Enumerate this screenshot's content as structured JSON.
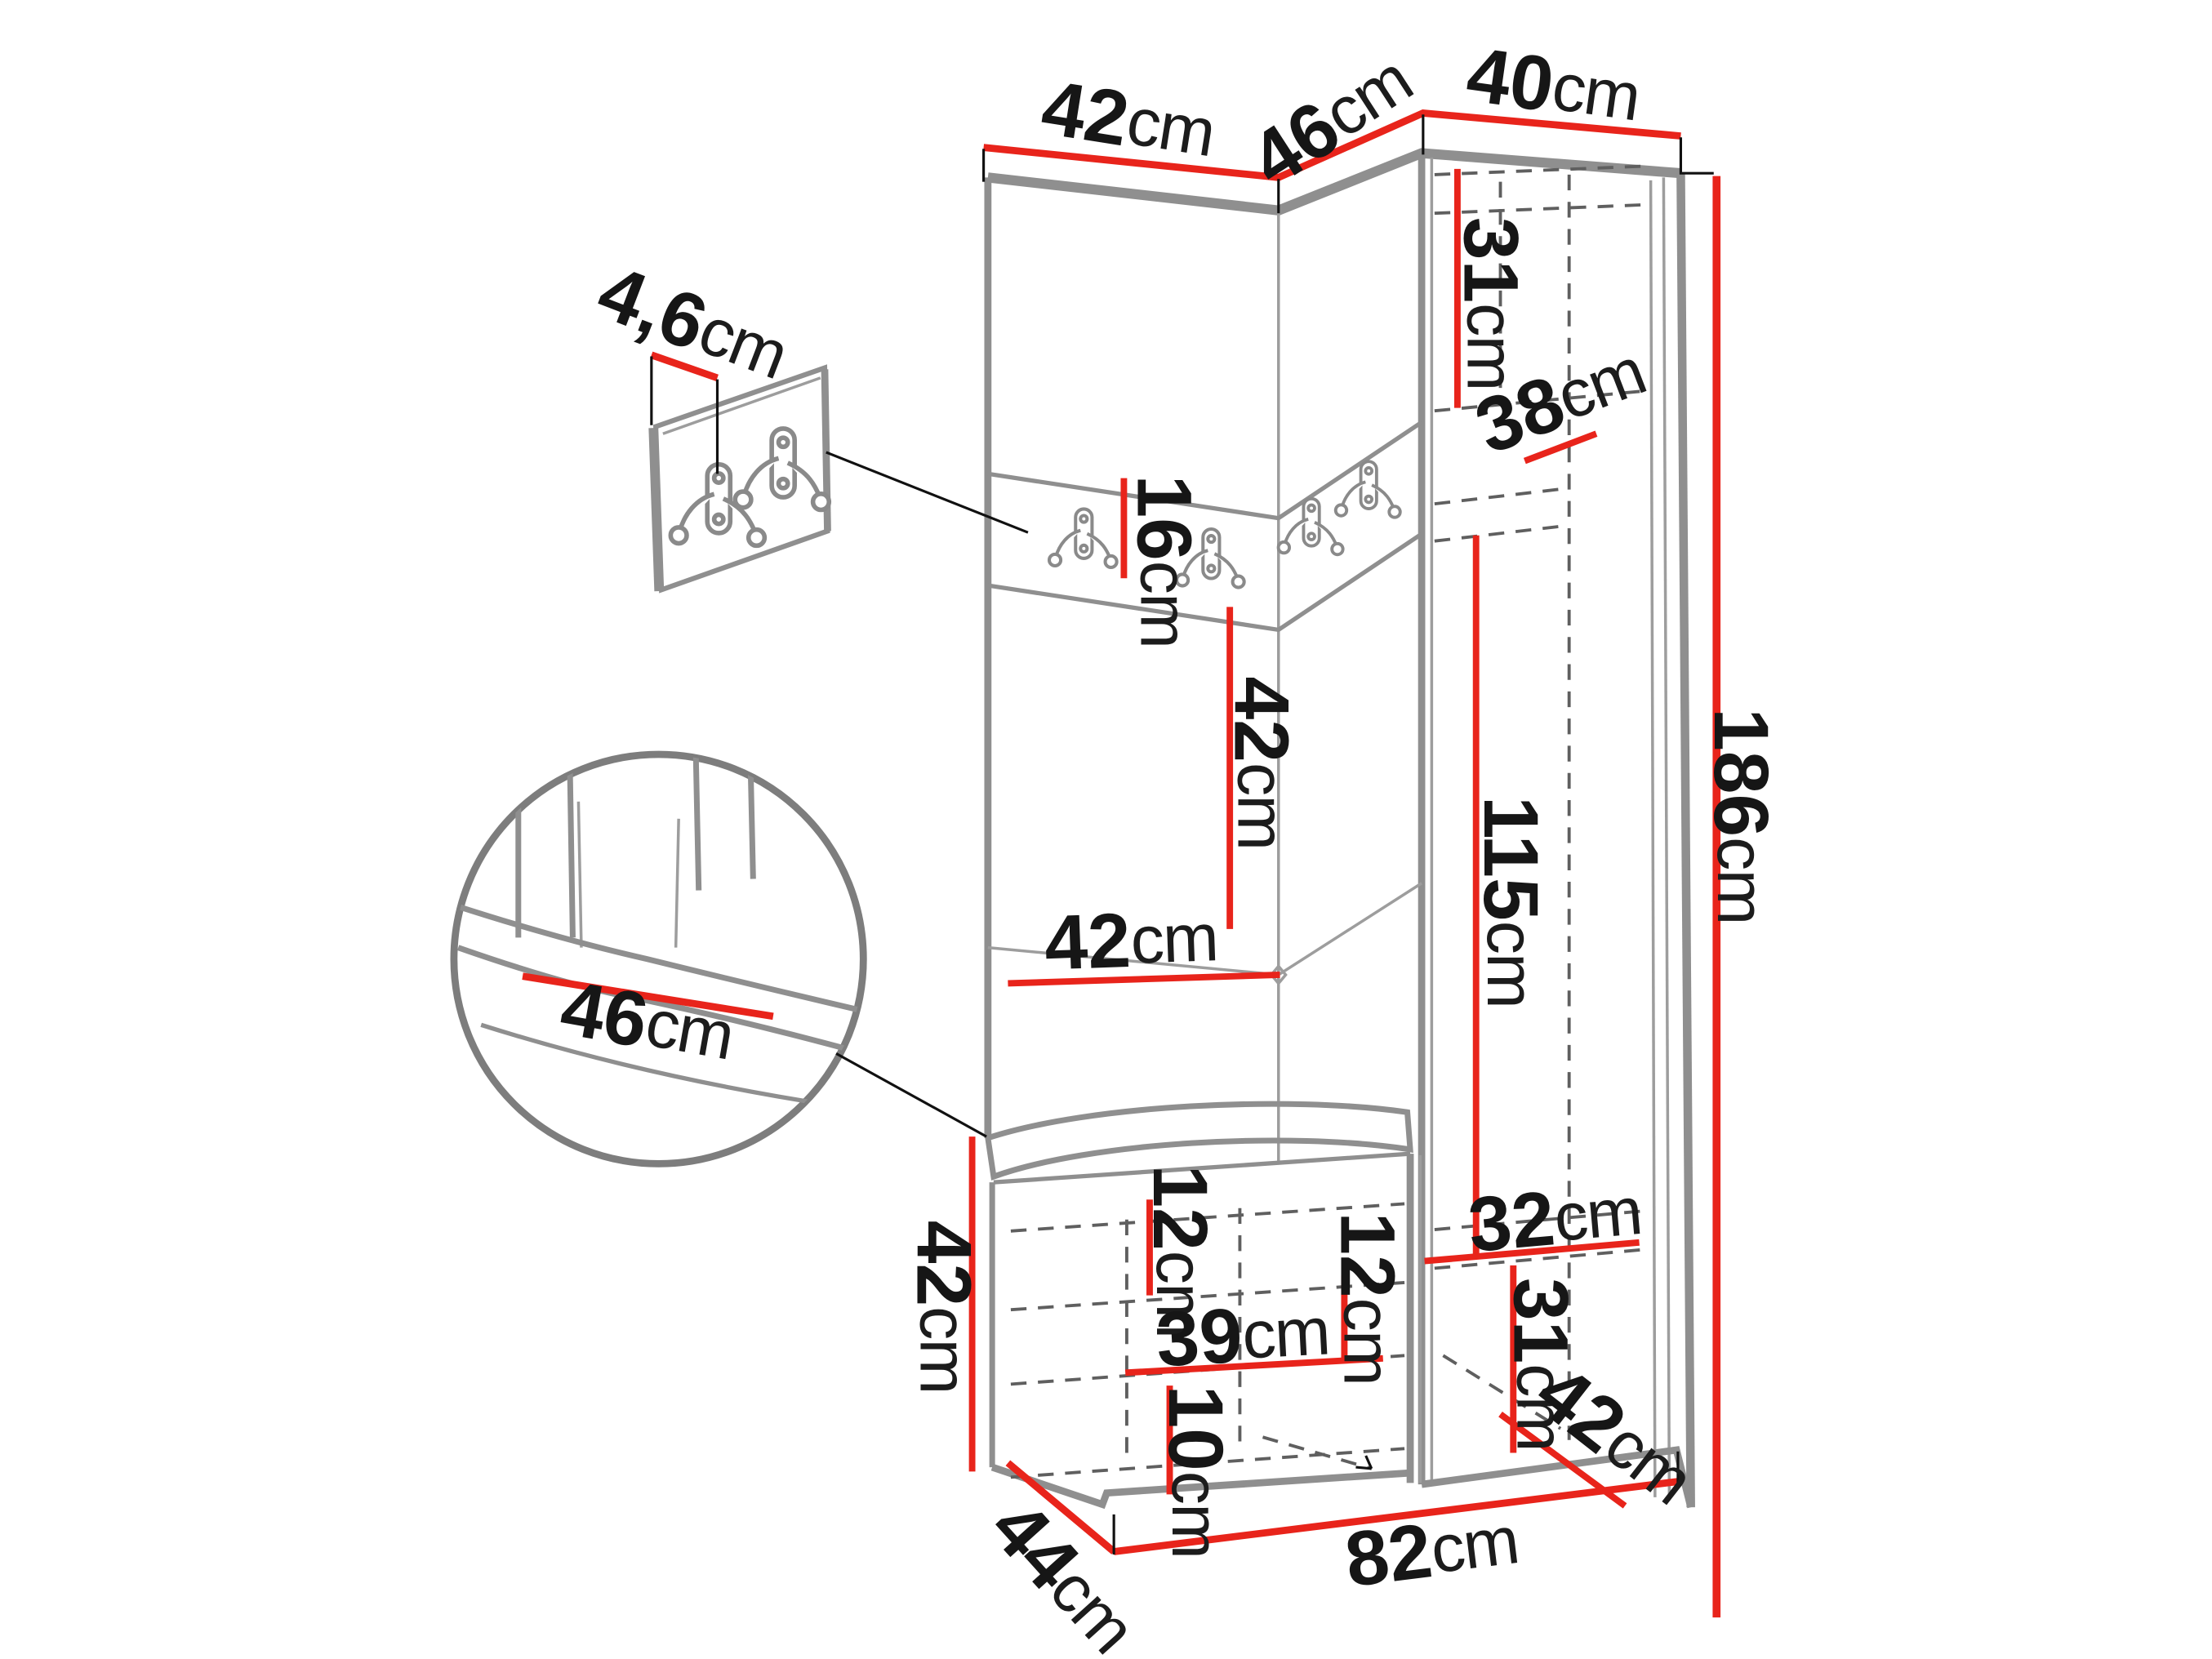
{
  "figure": {
    "type": "furniture-dimension-diagram",
    "subject": "hallway set: corner wardrobe with hook panel and storage bench",
    "unit": "cm",
    "accent_color": "#e8241b",
    "outline_color": "#8f8f8f",
    "text_color": "#161616",
    "background_color": "#ffffff"
  },
  "dims": {
    "top_width_left": {
      "num": "42",
      "unit": "cm"
    },
    "top_width_mid": {
      "num": "46",
      "unit": "cm"
    },
    "top_width_right": {
      "num": "40",
      "unit": "cm"
    },
    "panel_thickness": {
      "num": "4,6",
      "unit": "cm"
    },
    "hook_strip_height": {
      "num": "16",
      "unit": "cm"
    },
    "mid_panel_height": {
      "num": "42",
      "unit": "cm"
    },
    "mid_panel_width": {
      "num": "42",
      "unit": "cm"
    },
    "wardrobe_top_height": {
      "num": "31",
      "unit": "cm"
    },
    "wardrobe_top_depth": {
      "num": "38",
      "unit": "cm"
    },
    "wardrobe_inner_height": {
      "num": "115",
      "unit": "cm"
    },
    "total_height": {
      "num": "186",
      "unit": "cm"
    },
    "wardrobe_bottom_width": {
      "num": "32",
      "unit": "cm"
    },
    "wardrobe_bottom_height": {
      "num": "31",
      "unit": "cm"
    },
    "wardrobe_bottom_depth": {
      "num": "42",
      "unit": "cm"
    },
    "seat_width": {
      "num": "46",
      "unit": "cm"
    },
    "bench_height": {
      "num": "42",
      "unit": "cm"
    },
    "bench_top_inset": {
      "num": "12",
      "unit": "cm"
    },
    "bench_shelf_drop": {
      "num": "12",
      "unit": "cm"
    },
    "bench_shelf_width": {
      "num": "39",
      "unit": "cm"
    },
    "bench_bottom_space": {
      "num": "10",
      "unit": "cm"
    },
    "bench_depth": {
      "num": "44",
      "unit": "cm"
    },
    "base_width": {
      "num": "82",
      "unit": "cm"
    }
  }
}
